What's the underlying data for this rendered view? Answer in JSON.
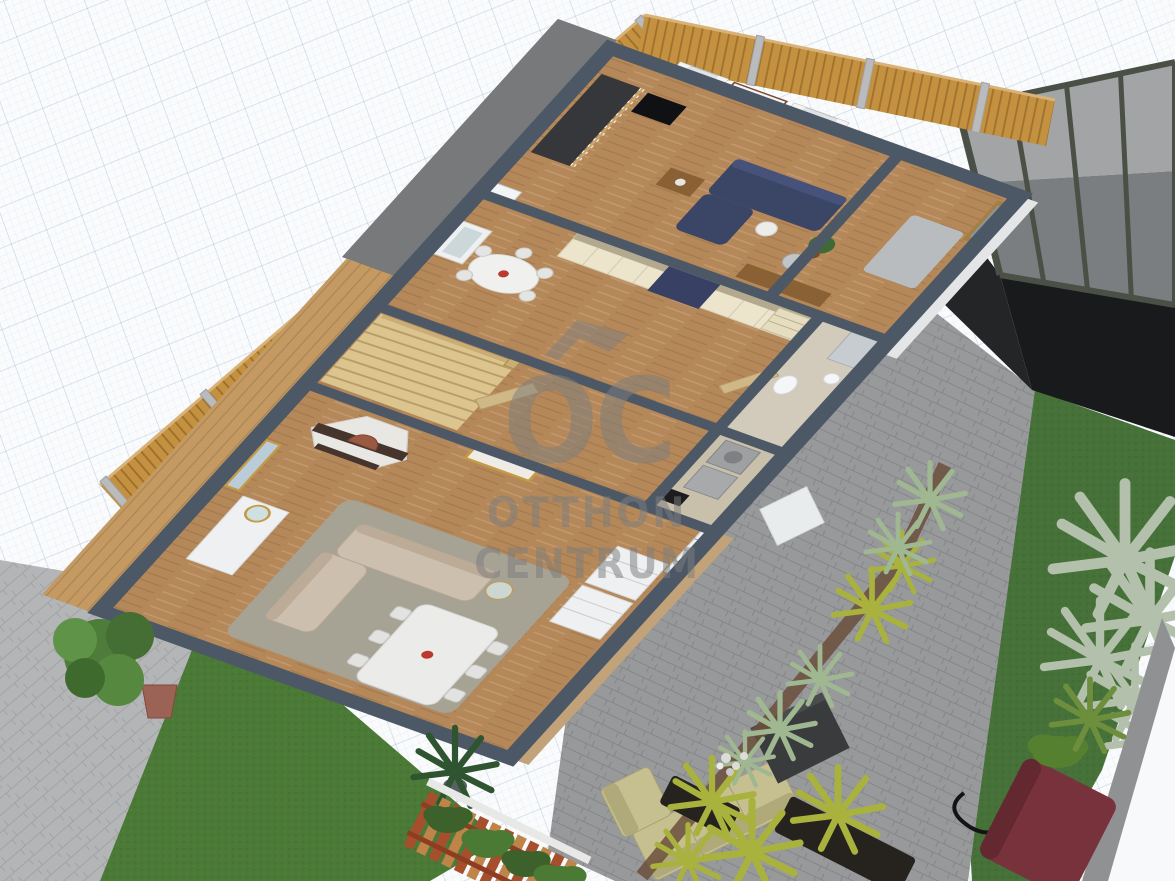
{
  "watermark": {
    "logo": "OC",
    "line1": "OTTHON",
    "line2": "CENTRUM",
    "color": "#7d7d7d"
  },
  "viewport": {
    "width": 1175,
    "height": 881,
    "type": "3d-floorplan-render",
    "background": "grid-paper"
  },
  "palette": {
    "canvas": "#fafbfc",
    "grid_line": "#c7d2e2",
    "wall_cap": "#4d5866",
    "wall_face": "#eef0f2",
    "wood_floor": "#b5885a",
    "fence_wood": "#c3913f",
    "fence_post": "#b9bbbd",
    "road_pavers": "#6f7073",
    "sidewalk_pavers": "#b4b5b7",
    "patio_pavers": "#98999b",
    "lawn": "#4b7a37",
    "kitchen_cabinets": "#ece4cb",
    "navy_accent": "#384064",
    "beige_sofa": "#cdbfae",
    "olive_outdoor_sofa": "#c6c091",
    "pergola_frame": "#4b5046",
    "pergola_glass": "#a2a4a6",
    "dark_floor": "#191a1c",
    "maroon_planter": "#77323b",
    "terracotta_pot": "#9b6355",
    "deck_wood": "#c49a62",
    "stair_wood": "#dcc48f"
  },
  "house": {
    "rooms": [
      {
        "id": "upper-living-office",
        "floor": "wood",
        "items": [
          "navy-sectional-sofa",
          "coffee-table",
          "tv-screen",
          "wall-art-triptych",
          "window-curtains",
          "floor-lamp",
          "desk",
          "office-chair",
          "potted-plant",
          "stair-railing"
        ]
      },
      {
        "id": "entry-hall",
        "floor": "wood",
        "items": [
          "glazed-entry-door",
          "doormat"
        ]
      },
      {
        "id": "kitchen",
        "floor": "wood",
        "items": [
          "cream-cabinet-wall",
          "navy-fridge",
          "open-shelves",
          "breakfast-table",
          "chairs",
          "mirror-door",
          "air-conditioner"
        ]
      },
      {
        "id": "bathroom",
        "floor": "tile",
        "items": [
          "shower",
          "toilet",
          "sink",
          "door"
        ]
      },
      {
        "id": "stair-hall",
        "floor": "wood",
        "items": [
          "winder-staircase",
          "open-door"
        ]
      },
      {
        "id": "laundry",
        "floor": "tile",
        "items": [
          "washer",
          "dryer",
          "black-appliance"
        ]
      },
      {
        "id": "living-dining",
        "floor": "wood",
        "items": [
          "corner-fireplace",
          "gold-frame-art",
          "wall-picture",
          "console-with-mirror",
          "beige-sofa-long",
          "beige-sofa-short",
          "area-rug",
          "dining-table",
          "dining-chairs-6",
          "red-centerpiece",
          "white-sideboard",
          "glazed-patio-door",
          "palm-plant"
        ]
      }
    ]
  },
  "garden": {
    "elements": [
      "west-fence",
      "north-fence",
      "paver-road",
      "sidewalk",
      "left-lawn",
      "potted-tree",
      "wood-deck",
      "paver-patio",
      "olive-outdoor-sectional",
      "dark-outdoor-table",
      "white-doormat",
      "planting-strip",
      "yellow-palms",
      "ornamental-grasses",
      "white-flowers",
      "right-lawn",
      "glass-pergola",
      "dark-pergola-floor",
      "maroon-planter",
      "green-shrubs",
      "red-slat-fence",
      "dark-planter-boxes",
      "curb-wall"
    ]
  }
}
